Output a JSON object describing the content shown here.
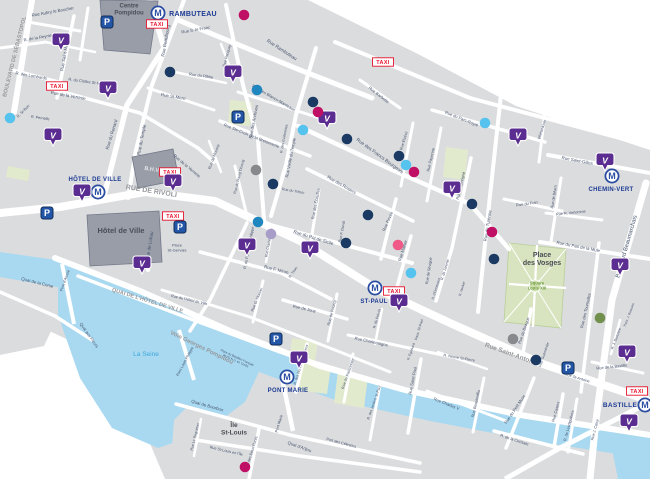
{
  "map_title": "Paris Marais district map",
  "colors": {
    "block": "#dbdcde",
    "road": "#ffffff",
    "water": "#a8d9f0",
    "park": "#e2eacd",
    "vosges_green": "#d8e4bf",
    "building": "#989da8",
    "metro_blue": "#2b4ea2",
    "metro_text": "#1c3a94",
    "taxi_red": "#e8132d",
    "parking_blue": "#2456a8",
    "velib_purple": "#5b2d90",
    "street_text": "#47556e",
    "major_road_text": "#95989c",
    "water_text": "#41a7da",
    "green_text": "#6f9f45",
    "place_text": "#4a4d55",
    "bhv_text": "#e6e6e8",
    "dot_palette": {
      "navy": "#1a3a63",
      "blue": "#1f86c0",
      "sky": "#55c3ee",
      "magenta": "#bf1065",
      "pink": "#ef5a89",
      "lavender": "#a89cc8",
      "gray": "#87898c",
      "olive": "#71904e"
    }
  },
  "metro_stations": [
    {
      "name": "RAMBUTEAU",
      "icon": [
        158,
        13
      ],
      "label": [
        193,
        16
      ],
      "size": 7
    },
    {
      "name": "HÔTEL DE VILLE",
      "icon": [
        98,
        192
      ],
      "label": [
        95,
        181
      ],
      "size": 6
    },
    {
      "name": "ST-PAUL",
      "icon": [
        375,
        288
      ],
      "label": [
        374,
        303
      ],
      "size": 6
    },
    {
      "name": "PONT MARIE",
      "icon": [
        287,
        377
      ],
      "label": [
        288,
        392
      ],
      "size": 6
    },
    {
      "name": "CHEMIN-VERT",
      "icon": [
        612,
        176
      ],
      "label": [
        611,
        191
      ],
      "size": 6
    },
    {
      "name": "BASTILLE",
      "icon": [
        645,
        405
      ],
      "label": [
        620,
        407
      ],
      "size": 6.5
    }
  ],
  "taxi_label": "TAXI",
  "metro_letter": "M",
  "parking_letter": "P",
  "velib_letter": "V",
  "taxi_stands": [
    [
      157,
      24
    ],
    [
      57,
      86
    ],
    [
      383,
      62
    ],
    [
      170,
      172
    ],
    [
      173,
      216
    ],
    [
      394,
      291
    ],
    [
      637,
      391
    ]
  ],
  "parking_icons": [
    [
      107,
      22
    ],
    [
      238,
      117
    ],
    [
      47,
      213
    ],
    [
      180,
      227
    ],
    [
      276,
      339
    ],
    [
      568,
      368
    ]
  ],
  "velib_markers": [
    [
      61,
      42
    ],
    [
      53,
      137
    ],
    [
      108,
      90
    ],
    [
      233,
      74
    ],
    [
      327,
      120
    ],
    [
      82,
      193
    ],
    [
      173,
      183
    ],
    [
      142,
      265
    ],
    [
      247,
      247
    ],
    [
      310,
      250
    ],
    [
      399,
      303
    ],
    [
      299,
      360
    ],
    [
      452,
      190
    ],
    [
      518,
      137
    ],
    [
      605,
      162
    ],
    [
      620,
      267
    ],
    [
      627,
      354
    ],
    [
      629,
      423
    ]
  ],
  "poi_dots": {
    "navy": [
      [
        170,
        72
      ],
      [
        313,
        102
      ],
      [
        347,
        139
      ],
      [
        399,
        156
      ],
      [
        273,
        184
      ],
      [
        368,
        215
      ],
      [
        346,
        243
      ],
      [
        472,
        204
      ],
      [
        494,
        259
      ],
      [
        536,
        360
      ]
    ],
    "blue": [
      [
        257,
        90
      ],
      [
        258,
        222
      ]
    ],
    "sky": [
      [
        10,
        118
      ],
      [
        303,
        130
      ],
      [
        406,
        165
      ],
      [
        485,
        123
      ],
      [
        411,
        273
      ]
    ],
    "magenta": [
      [
        244,
        15
      ],
      [
        318,
        112
      ],
      [
        414,
        172
      ],
      [
        492,
        232
      ],
      [
        245,
        467
      ]
    ],
    "pink": [
      [
        398,
        245
      ]
    ],
    "lavender": [
      [
        271,
        234
      ]
    ],
    "gray": [
      [
        256,
        170
      ],
      [
        513,
        339
      ]
    ],
    "olive": [
      [
        600,
        318
      ]
    ]
  },
  "labels": [
    {
      "t": [
        "Centre",
        "Pompidou"
      ],
      "x": 129,
      "y": 11,
      "r": 0,
      "s": 6,
      "c": "pl"
    },
    {
      "t": "Hôtel de Ville",
      "x": 121,
      "y": 233,
      "r": 0,
      "s": 7.5,
      "c": "pl"
    },
    {
      "t": "B.H.V.",
      "x": 152,
      "y": 171,
      "r": 8,
      "s": 5.5,
      "c": "bh"
    },
    {
      "t": [
        "Place",
        "des Vosges"
      ],
      "x": 542,
      "y": 261,
      "r": 0,
      "s": 7,
      "c": "pl"
    },
    {
      "t": [
        "Square",
        "Louis XIII"
      ],
      "x": 537,
      "y": 287,
      "r": 0,
      "s": 4.2,
      "c": "gr"
    },
    {
      "t": [
        "Île",
        "St-Louis"
      ],
      "x": 234,
      "y": 431,
      "r": 0,
      "s": 6.5,
      "c": "pl"
    },
    {
      "t": "La Seine",
      "x": 146,
      "y": 356,
      "r": 0,
      "s": 6.5,
      "c": "wa"
    },
    {
      "t": [
        "Place",
        "St-Gervais"
      ],
      "x": 177,
      "y": 249,
      "r": 0,
      "s": 4,
      "c": "st"
    },
    {
      "t": "RUE DE RIVOLI",
      "x": 151,
      "y": 193,
      "r": 9,
      "s": 7,
      "c": "mj"
    },
    {
      "t": "QUAI DE L'HÔTEL DE VILLE",
      "x": 147,
      "y": 302,
      "r": 17,
      "s": 5.5,
      "c": "mj"
    },
    {
      "t": "Voie Georges Pompidou",
      "x": 201,
      "y": 349,
      "r": 26,
      "s": 6,
      "c": "mj"
    },
    {
      "t": "Rue Saint-Antoine",
      "x": 511,
      "y": 356,
      "r": 20,
      "s": 6.5,
      "c": "mj"
    },
    {
      "t": "BOULEVARD DE SÉBASTOPOL",
      "x": 16,
      "y": 57,
      "r": -76,
      "s": 5.5,
      "c": "mj"
    },
    {
      "t": "Boulevard Beaumarchais",
      "x": 628,
      "y": 247,
      "r": -74,
      "s": 5.8,
      "c": "st"
    },
    {
      "t": "Rue Aubry le Boucher",
      "x": 53,
      "y": 13,
      "r": -10,
      "s": 4.4,
      "c": "st"
    },
    {
      "t": "R. de la Reynie",
      "x": 38,
      "y": 39,
      "r": -10,
      "s": 4.2,
      "c": "st"
    },
    {
      "t": "Rue Saint-Martin",
      "x": 66,
      "y": 55,
      "r": -80,
      "s": 4.4,
      "c": "st"
    },
    {
      "t": "R. des Lombards",
      "x": 31,
      "y": 77,
      "r": 10,
      "s": 4.2,
      "c": "st"
    },
    {
      "t": "R. St-Bon",
      "x": 24,
      "y": 112,
      "r": -45,
      "s": 3.8,
      "c": "st"
    },
    {
      "t": "R. Pernelle",
      "x": 40,
      "y": 119,
      "r": 8,
      "s": 3.8,
      "c": "st"
    },
    {
      "t": "R. du Cloître St-Merri",
      "x": 87,
      "y": 83,
      "r": 8,
      "s": 4,
      "c": "st"
    },
    {
      "t": "Rue de la Verrerie",
      "x": 68,
      "y": 97,
      "r": 10,
      "s": 4.4,
      "c": "st"
    },
    {
      "t": "Rue de la Verrerie",
      "x": 186,
      "y": 167,
      "r": 40,
      "s": 4.2,
      "c": "st"
    },
    {
      "t": "Rue St-Merri",
      "x": 173,
      "y": 98,
      "r": 10,
      "s": 4.4,
      "c": "st"
    },
    {
      "t": "Rue du Renard",
      "x": 113,
      "y": 135,
      "r": -73,
      "s": 4.6,
      "c": "st"
    },
    {
      "t": "Rue du Temple",
      "x": 143,
      "y": 140,
      "r": -79,
      "s": 4.6,
      "c": "st"
    },
    {
      "t": "Rue Beaubourg",
      "x": 167,
      "y": 41,
      "r": -80,
      "s": 4.6,
      "c": "st"
    },
    {
      "t": "Rue S. le Franc",
      "x": 196,
      "y": 31,
      "r": -10,
      "s": 4.2,
      "c": "st"
    },
    {
      "t": "Rue Pecquay",
      "x": 228,
      "y": 56,
      "r": -75,
      "s": 3.8,
      "c": "st"
    },
    {
      "t": "Rue Rambuteau",
      "x": 281,
      "y": 51,
      "r": 33,
      "s": 4.8,
      "c": "st"
    },
    {
      "t": "Rue du Plâtre",
      "x": 201,
      "y": 77,
      "r": 8,
      "s": 4,
      "c": "st"
    },
    {
      "t": "Rue des Archives",
      "x": 255,
      "y": 122,
      "r": -79,
      "s": 4.4,
      "c": "st"
    },
    {
      "t": "R. des Guillemites",
      "x": 285,
      "y": 139,
      "r": -79,
      "s": 3.6,
      "c": "st"
    },
    {
      "t": "Rue de Moussy",
      "x": 215,
      "y": 157,
      "r": -70,
      "s": 3.8,
      "c": "st"
    },
    {
      "t": "Rue Ste-Croix de la Bretonnerie",
      "x": 251,
      "y": 137,
      "r": 22,
      "s": 4.2,
      "c": "st"
    },
    {
      "t": "Rue des Blancs-Manteaux",
      "x": 273,
      "y": 99,
      "r": 30,
      "s": 4.2,
      "c": "st"
    },
    {
      "t": "Rue Vieille du Temple",
      "x": 292,
      "y": 158,
      "r": -79,
      "s": 4.2,
      "c": "st"
    },
    {
      "t": "Rue des Francs Bourgeois",
      "x": 379,
      "y": 157,
      "r": 36,
      "s": 4.8,
      "c": "st"
    },
    {
      "t": "Rue Barbette",
      "x": 378,
      "y": 96,
      "r": 38,
      "s": 4.2,
      "c": "st"
    },
    {
      "t": "Rue des Rosiers",
      "x": 341,
      "y": 186,
      "r": 30,
      "s": 4.4,
      "c": "st"
    },
    {
      "t": "Rue des Écouffes",
      "x": 317,
      "y": 204,
      "r": -79,
      "s": 4,
      "c": "st"
    },
    {
      "t": "Rue F. Duval",
      "x": 343,
      "y": 232,
      "r": -79,
      "s": 3.8,
      "c": "st"
    },
    {
      "t": "Rue Pavée",
      "x": 389,
      "y": 222,
      "r": -66,
      "s": 4.2,
      "c": "st"
    },
    {
      "t": "Rue Malher",
      "x": 404,
      "y": 251,
      "r": -73,
      "s": 4.2,
      "c": "st"
    },
    {
      "t": "Rue du Roi de Sicile",
      "x": 313,
      "y": 239,
      "r": 17,
      "s": 4.6,
      "c": "st"
    },
    {
      "t": "Rue du Trésor",
      "x": 293,
      "y": 192,
      "r": 10,
      "s": 3.6,
      "c": "st"
    },
    {
      "t": "Rue du Bourg Tibourg",
      "x": 240,
      "y": 177,
      "r": -76,
      "s": 3.6,
      "c": "st"
    },
    {
      "t": "Rue Cloche Perce",
      "x": 270,
      "y": 243,
      "r": -79,
      "s": 3.6,
      "c": "st"
    },
    {
      "t": "R. Tiron",
      "x": 294,
      "y": 273,
      "r": -55,
      "s": 3.6,
      "c": "st"
    },
    {
      "t": "R. du Pont Louis-Philippe",
      "x": 250,
      "y": 248,
      "r": -79,
      "s": 3.8,
      "c": "st"
    },
    {
      "t": "Rue F. Miron",
      "x": 276,
      "y": 271,
      "r": 14,
      "s": 4.4,
      "c": "st"
    },
    {
      "t": "Rue de Lobau",
      "x": 151,
      "y": 246,
      "r": -81,
      "s": 4.6,
      "c": "st"
    },
    {
      "t": "Pont d'Arcole",
      "x": 66,
      "y": 281,
      "r": -70,
      "s": 3.8,
      "c": "st"
    },
    {
      "t": "Quai de la Corse",
      "x": 37,
      "y": 284,
      "r": 14,
      "s": 4.4,
      "c": "st"
    },
    {
      "t": "Quai aux Fleurs",
      "x": 88,
      "y": 336,
      "r": 55,
      "s": 4.2,
      "c": "st"
    },
    {
      "t": "Pont Louis Philippe",
      "x": 186,
      "y": 362,
      "r": -62,
      "s": 3.8,
      "c": "st"
    },
    {
      "t": "Pont Marie",
      "x": 280,
      "y": 424,
      "r": -73,
      "s": 3.8,
      "c": "st"
    },
    {
      "t": "Quai de Bourbon",
      "x": 207,
      "y": 407,
      "r": 16,
      "s": 4.4,
      "c": "st"
    },
    {
      "t": "Rue Le Regrattier",
      "x": 196,
      "y": 437,
      "r": -76,
      "s": 3.6,
      "c": "st"
    },
    {
      "t": "Rue St-Louis en l'Île",
      "x": 226,
      "y": 452,
      "r": 13,
      "s": 3.8,
      "c": "st"
    },
    {
      "t": "R. des Deux Ponts",
      "x": 253,
      "y": 452,
      "r": -73,
      "s": 3.8,
      "c": "st"
    },
    {
      "t": "Quai d'Anjou",
      "x": 299,
      "y": 448,
      "r": 20,
      "s": 4.4,
      "c": "st"
    },
    {
      "t": "Port des Célestins",
      "x": 341,
      "y": 444,
      "r": 15,
      "s": 3.8,
      "c": "st"
    },
    {
      "t": "Rue de l'Hôtel de Ville",
      "x": 189,
      "y": 301,
      "r": 13,
      "s": 3.8,
      "c": "st"
    },
    {
      "t": "Rue G. l'Asnier",
      "x": 258,
      "y": 300,
      "r": -68,
      "s": 3.8,
      "c": "st"
    },
    {
      "t": "Rue de Jouy",
      "x": 304,
      "y": 310,
      "r": 13,
      "s": 4.2,
      "c": "st"
    },
    {
      "t": "Rue de Fourcy",
      "x": 333,
      "y": 313,
      "r": -76,
      "s": 4,
      "c": "st"
    },
    {
      "t": "R. des Nonnains d'Hyères",
      "x": 302,
      "y": 365,
      "r": -73,
      "s": 3.6,
      "c": "st"
    },
    {
      "t": "Rue du Fauconnier",
      "x": 349,
      "y": 374,
      "r": -71,
      "s": 3.8,
      "c": "st"
    },
    {
      "t": "R. des Jardins St-Paul",
      "x": 375,
      "y": 403,
      "r": -71,
      "s": 3.6,
      "c": "st"
    },
    {
      "t": "Rue Charlemagne",
      "x": 371,
      "y": 343,
      "r": 12,
      "s": 4.2,
      "c": "st"
    },
    {
      "t": "R. du Prévôt",
      "x": 378,
      "y": 319,
      "r": -73,
      "s": 3.6,
      "c": "st"
    },
    {
      "t": "R. Eginhard",
      "x": 412,
      "y": 352,
      "r": -70,
      "s": 3.4,
      "c": "st"
    },
    {
      "t": "Pass. St-Paul",
      "x": 420,
      "y": 330,
      "r": -73,
      "s": 3.6,
      "c": "st"
    },
    {
      "t": "Rue Saint-Paul",
      "x": 414,
      "y": 381,
      "r": -79,
      "s": 4.2,
      "c": "st"
    },
    {
      "t": "R. Neuve St-Pierre",
      "x": 459,
      "y": 359,
      "r": 10,
      "s": 3.8,
      "c": "st"
    },
    {
      "t": "Rue Beautreillis",
      "x": 477,
      "y": 404,
      "r": -77,
      "s": 4,
      "c": "st"
    },
    {
      "t": "Rue Charles V",
      "x": 446,
      "y": 405,
      "r": 22,
      "s": 4.2,
      "c": "st"
    },
    {
      "t": "Rue du Petit Musc",
      "x": 516,
      "y": 410,
      "r": -56,
      "s": 4.2,
      "c": "st"
    },
    {
      "t": "R. de la Cerisaie",
      "x": 514,
      "y": 441,
      "r": 18,
      "s": 4,
      "c": "st"
    },
    {
      "t": "Rue Castex",
      "x": 557,
      "y": 412,
      "r": -75,
      "s": 4,
      "c": "st"
    },
    {
      "t": "R. de Lesdiguières",
      "x": 570,
      "y": 426,
      "r": -75,
      "s": 3.8,
      "c": "st"
    },
    {
      "t": "Rue J. Cœur",
      "x": 596,
      "y": 430,
      "r": -75,
      "s": 3.8,
      "c": "st"
    },
    {
      "t": "Rue St-Antoine",
      "x": 577,
      "y": 379,
      "r": 17,
      "s": 3.8,
      "c": "st"
    },
    {
      "t": "Rue de Birague",
      "x": 525,
      "y": 331,
      "r": -71,
      "s": 4,
      "c": "st"
    },
    {
      "t": "Imp. Guéménée",
      "x": 545,
      "y": 355,
      "r": -71,
      "s": 3.6,
      "c": "st"
    },
    {
      "t": "Rue de la Bastille",
      "x": 612,
      "y": 368,
      "r": -6,
      "s": 4,
      "c": "st"
    },
    {
      "t": "R. J. Beausire",
      "x": 617,
      "y": 339,
      "r": -69,
      "s": 3.6,
      "c": "st"
    },
    {
      "t": "Pass. J. Beausire",
      "x": 630,
      "y": 315,
      "r": -69,
      "s": 3.2,
      "c": "st"
    },
    {
      "t": "Rue des Tournelles",
      "x": 587,
      "y": 311,
      "r": -77,
      "s": 4.2,
      "c": "st"
    },
    {
      "t": "Rue du Pas de la Mule",
      "x": 578,
      "y": 248,
      "r": 11,
      "s": 4.4,
      "c": "st"
    },
    {
      "t": "Rue Saint-Gilles",
      "x": 577,
      "y": 162,
      "r": 11,
      "s": 4.4,
      "c": "st"
    },
    {
      "t": "Rue du Foin",
      "x": 527,
      "y": 205,
      "r": -8,
      "s": 4,
      "c": "st"
    },
    {
      "t": "Rue R. Verlomme",
      "x": 571,
      "y": 214,
      "r": -6,
      "s": 3.8,
      "c": "st"
    },
    {
      "t": "Rue de Béarn",
      "x": 555,
      "y": 197,
      "r": -81,
      "s": 3.8,
      "c": "st"
    },
    {
      "t": "Villehardouin",
      "x": 543,
      "y": 130,
      "r": -73,
      "s": 3.6,
      "c": "st"
    },
    {
      "t": "Rue de Sévigné",
      "x": 462,
      "y": 186,
      "r": -77,
      "s": 4,
      "c": "st"
    },
    {
      "t": "Rue de Sévigné",
      "x": 430,
      "y": 271,
      "r": -81,
      "s": 3.8,
      "c": "st"
    },
    {
      "t": "R. de Jarente",
      "x": 446,
      "y": 270,
      "r": -73,
      "s": 3.6,
      "c": "st"
    },
    {
      "t": "R. d'Ormesson",
      "x": 437,
      "y": 289,
      "r": -73,
      "s": 3.4,
      "c": "st"
    },
    {
      "t": "R. Necker",
      "x": 463,
      "y": 289,
      "r": -73,
      "s": 3.4,
      "c": "st"
    },
    {
      "t": "Rue Payenne",
      "x": 432,
      "y": 160,
      "r": -77,
      "s": 4,
      "c": "st"
    },
    {
      "t": "Rue Elzévir",
      "x": 405,
      "y": 141,
      "r": -73,
      "s": 3.8,
      "c": "st"
    },
    {
      "t": "Rue de Turenne",
      "x": 489,
      "y": 226,
      "r": -81,
      "s": 4.4,
      "c": "st"
    },
    {
      "t": "Rue du Parc-Royal",
      "x": 461,
      "y": 120,
      "r": 22,
      "s": 4.2,
      "c": "st"
    },
    {
      "t": [
        "Place du Bataillon Français",
        "de l'O.N.U. en Corée"
      ],
      "x": 236,
      "y": 360,
      "r": 25,
      "s": 3,
      "c": "st"
    }
  ]
}
